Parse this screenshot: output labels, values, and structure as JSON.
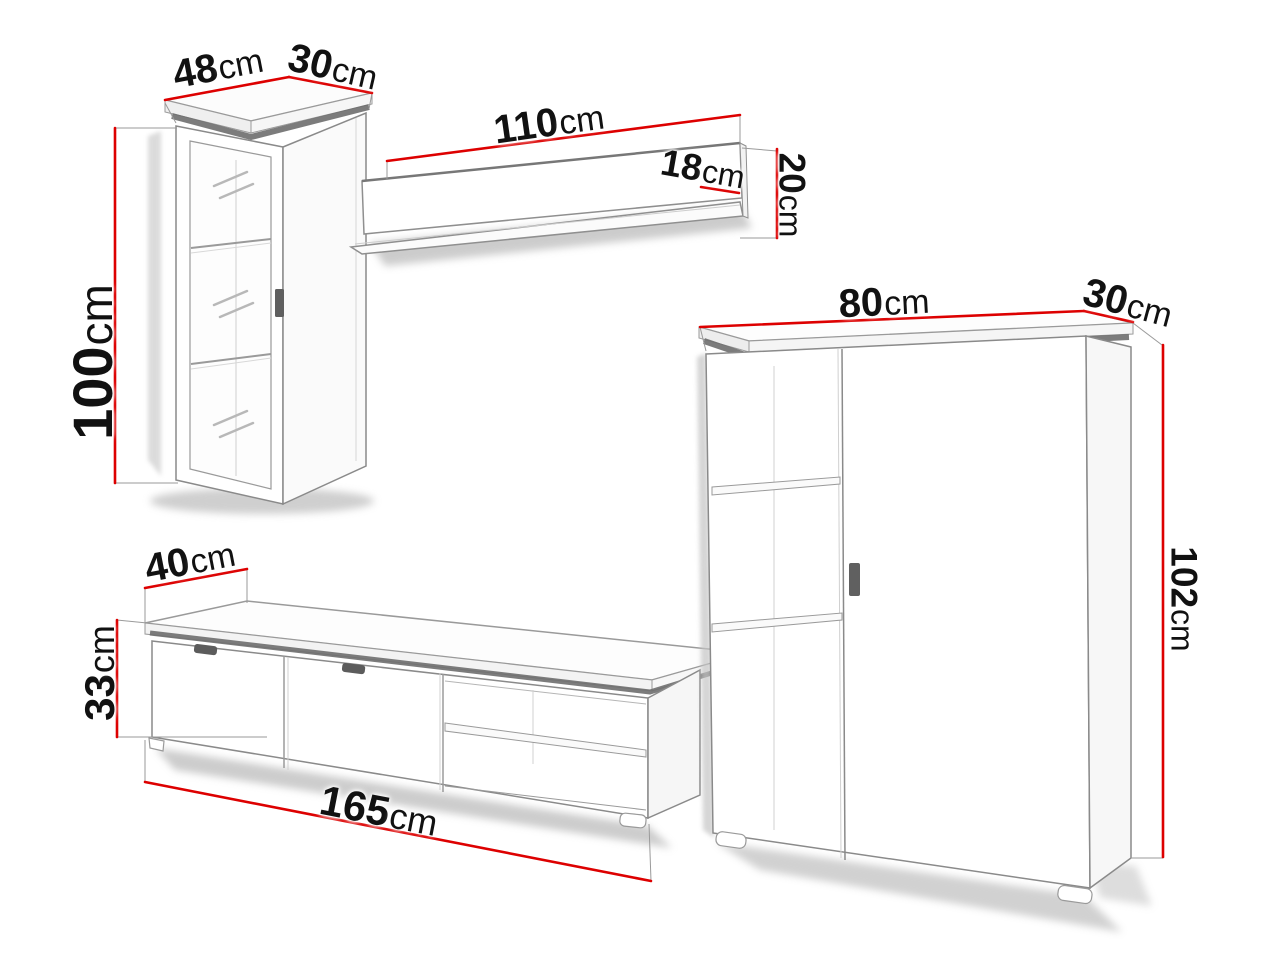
{
  "title": "Wall unit furniture dimensions diagram",
  "unit": "cm",
  "colors": {
    "dimension_line": "#dd0000",
    "outline": "#8a8a8a",
    "label_text": "#111111",
    "background": "#ffffff"
  },
  "components": {
    "wall_cabinet": {
      "width": {
        "value": "48",
        "unit": "cm"
      },
      "depth": {
        "value": "30",
        "unit": "cm"
      },
      "height": {
        "value": "100",
        "unit": "cm"
      }
    },
    "wall_shelf": {
      "width": {
        "value": "110",
        "unit": "cm"
      },
      "depth": {
        "value": "18",
        "unit": "cm"
      },
      "height": {
        "value": "20",
        "unit": "cm"
      }
    },
    "highboard": {
      "width": {
        "value": "80",
        "unit": "cm"
      },
      "depth": {
        "value": "30",
        "unit": "cm"
      },
      "height": {
        "value": "102",
        "unit": "cm"
      }
    },
    "tv_stand": {
      "width": {
        "value": "165",
        "unit": "cm"
      },
      "depth": {
        "value": "40",
        "unit": "cm"
      },
      "height": {
        "value": "33",
        "unit": "cm"
      }
    }
  }
}
